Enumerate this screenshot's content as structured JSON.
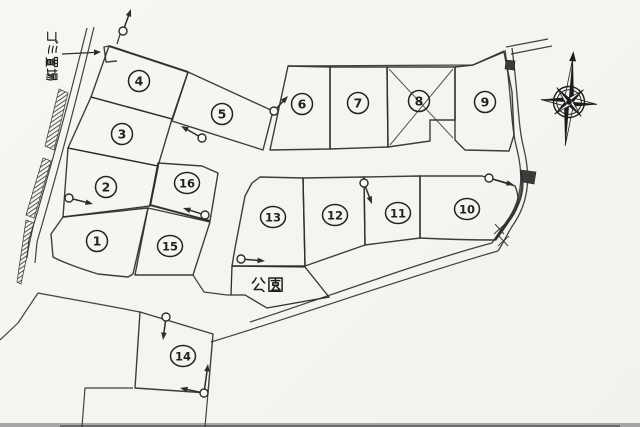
{
  "meta": {
    "description": "Scanned land subdivision site plan with 16 numbered lots, park, garbage station label and compass rose",
    "paper_color": "#f6f5f1",
    "ink_color": "#2d2d2d",
    "width": 640,
    "height": 427
  },
  "labels": {
    "park": "公園",
    "garbage_station": "ゴミ置場"
  },
  "park": {
    "outline": "M232,266 L305,267 L329,297 L267,308 L245,295 L231,295 Z",
    "label_x": 251,
    "label_y": 277,
    "glyph_size": 15
  },
  "garbage_label": {
    "x": 46,
    "y": 31,
    "glyph_size": 12,
    "rotated": true,
    "arrow": {
      "x1": 62,
      "y1": 54,
      "x2": 101,
      "y2": 52
    }
  },
  "lots": [
    {
      "no": "1",
      "cx": 97,
      "cy": 241,
      "outline": "M63,217 L148,208 L133,274 L128,277 L98,274 C78,268 60,261 53,257 L51,234 Z"
    },
    {
      "no": "2",
      "cx": 106,
      "cy": 187,
      "outline": "M68,148 L158,166 L150,206 L63,217 Z"
    },
    {
      "no": "3",
      "cx": 122,
      "cy": 134,
      "outline": "M91,97 L172,119 L158,166 L68,148 Z"
    },
    {
      "no": "4",
      "cx": 139,
      "cy": 81,
      "outline": "M109,46 L188,72 L172,119 L91,97 Z"
    },
    {
      "no": "5",
      "cx": 222,
      "cy": 114,
      "outline": "M188,72 L273,111 L263,150 L172,121 Z"
    },
    {
      "no": "6",
      "cx": 302,
      "cy": 104,
      "outline": "M288,66 L330,67 L330,149 L270,150 Z"
    },
    {
      "no": "7",
      "cx": 358,
      "cy": 103,
      "outline": "M330,67 L387,67 L388,147 L330,149 Z"
    },
    {
      "no": "8",
      "cx": 419,
      "cy": 101,
      "outline": "M387,67 L455,67 L455,120 L430,120 L430,141 L388,147 Z",
      "crossed": true
    },
    {
      "no": "9",
      "cx": 485,
      "cy": 102,
      "outline": "M455,67 L473,65 L504,52 L512,92 L514,135 L509,151 L465,150 L455,140 Z"
    },
    {
      "no": "10",
      "cx": 467,
      "cy": 209,
      "outline": "M420,176 L482,176 L515,186 C521,200 518,211 508,222 L495,240 C470,240 440,239 420,238 Z"
    },
    {
      "no": "11",
      "cx": 398,
      "cy": 213,
      "outline": "M364,177 L420,176 L420,238 L365,245 Z"
    },
    {
      "no": "12",
      "cx": 335,
      "cy": 215,
      "outline": "M303,178 L364,177 L365,245 L305,266 Z"
    },
    {
      "no": "13",
      "cx": 273,
      "cy": 217,
      "outline": "M260,177 L303,178 L305,266 L232,266 L235,248 L245,196 L252,183 Z"
    },
    {
      "no": "14",
      "cx": 183,
      "cy": 356,
      "outline": "M140,312 L213,334 L208,393 L135,388 Z"
    },
    {
      "no": "15",
      "cx": 170,
      "cy": 246,
      "outline": "M148,208 L210,222 L193,275 L135,275 Z"
    },
    {
      "no": "16",
      "cx": 187,
      "cy": 183,
      "outline": "M158,163 L202,166 L218,173 L210,221 L150,205 Z"
    }
  ],
  "lot8_cross": [
    "M389,69 L453,138",
    "M453,69 L390,145"
  ],
  "roads": [
    {
      "d": "M87,28 C76,72 57,148 29,240 L27,258",
      "w": 1.2
    },
    {
      "d": "M94,27 C83,73 64,150 37,242 L35,263",
      "w": 1.2
    },
    {
      "d": "M121,31 L117,44",
      "w": 1.3
    },
    {
      "d": "M109,46 L104,47 L106,62 L117,61",
      "w": 1.4
    },
    {
      "d": "M288,66 L473,65 L504,51",
      "w": 1.3
    },
    {
      "d": "M0,340 L18,323 L38,293 C70,299 110,306 140,312",
      "w": 1.2
    },
    {
      "d": "M250,322 C310,303 420,262 492,243",
      "w": 1.3
    },
    {
      "d": "M211,342 C300,315 420,273 498,251",
      "w": 1.2
    },
    {
      "d": "M505,50 C511,92 511,125 516,145 C520,162 527,190 509,218 C504,225 498,234 492,243",
      "w": 1.3
    },
    {
      "d": "M512,48 C518,92 518,125 523,145 C527,162 534,192 515,222 C509,230 504,242 498,251",
      "w": 1.3
    },
    {
      "d": "M506,47 L548,39",
      "w": 1.2
    },
    {
      "d": "M511,54 L552,46",
      "w": 1.2
    },
    {
      "d": "M521,171 C526,194 518,210 495,240",
      "w": 2.6
    },
    {
      "d": "M193,275 L204,292 L227,295 L231,295",
      "w": 1.2
    },
    {
      "d": "M133,388 L85,388 L82,427",
      "w": 1.2
    },
    {
      "d": "M208,393 L205,427",
      "w": 1.2
    },
    {
      "d": "M494,234 L505,224",
      "w": 1
    },
    {
      "d": "M495,224 L504,234",
      "w": 1
    },
    {
      "d": "M498,246 L509,236",
      "w": 1
    },
    {
      "d": "M499,236 L508,246",
      "w": 1
    }
  ],
  "hatch_strips": [
    {
      "points": "59,89 68,93 54,150 45,146"
    },
    {
      "points": "43,158 51,161 34,218 26,215"
    },
    {
      "points": "26,220 34,223 21,284 17,282"
    }
  ],
  "dark_patches": [
    {
      "points": "521,170 536,172 534,184 523,182"
    },
    {
      "points": "506,60 515,61 514,70 505,69"
    }
  ],
  "survey_markers": [
    {
      "cx": 123,
      "cy": 31,
      "tips": [
        [
          131,
          9
        ]
      ]
    },
    {
      "cx": 274,
      "cy": 111,
      "tips": [
        [
          288,
          96
        ]
      ]
    },
    {
      "cx": 202,
      "cy": 138,
      "tips": [
        [
          181,
          126
        ]
      ]
    },
    {
      "cx": 69,
      "cy": 198,
      "tips": [
        [
          93,
          204
        ]
      ]
    },
    {
      "cx": 205,
      "cy": 215,
      "tips": [
        [
          183,
          208
        ]
      ]
    },
    {
      "cx": 241,
      "cy": 259,
      "tips": [
        [
          265,
          261
        ]
      ]
    },
    {
      "cx": 364,
      "cy": 183,
      "tips": [
        [
          372,
          204
        ]
      ]
    },
    {
      "cx": 489,
      "cy": 178,
      "tips": [
        [
          514,
          185
        ]
      ]
    },
    {
      "cx": 166,
      "cy": 317,
      "tips": [
        [
          163,
          340
        ]
      ]
    },
    {
      "cx": 204,
      "cy": 393,
      "tips": [
        [
          208,
          364
        ],
        [
          180,
          388
        ]
      ]
    }
  ],
  "compass": {
    "cx": 569,
    "cy": 102,
    "rotation": 5,
    "n_len": 45,
    "s_len": 44,
    "ew_len": 28,
    "diag_len": 19
  }
}
